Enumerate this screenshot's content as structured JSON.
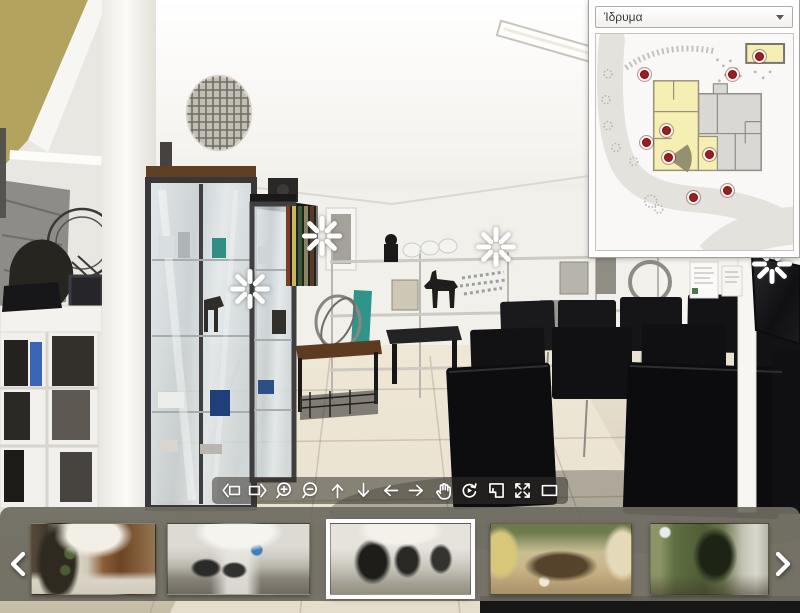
{
  "viewer": {
    "name": "panorama-virtual-tour",
    "sparkles": [
      {
        "x": 322,
        "y": 236
      },
      {
        "x": 250,
        "y": 289
      },
      {
        "x": 496,
        "y": 247
      },
      {
        "x": 772,
        "y": 264
      }
    ]
  },
  "map_panel": {
    "dropdown": {
      "value": "Ίδρυμα",
      "caret_icon": "chevron-down-icon"
    },
    "hotspots": [
      {
        "x": 48,
        "y": 40
      },
      {
        "x": 136,
        "y": 40
      },
      {
        "x": 163,
        "y": 22
      },
      {
        "x": 70,
        "y": 96
      },
      {
        "x": 50,
        "y": 108
      },
      {
        "x": 72,
        "y": 123
      },
      {
        "x": 113,
        "y": 120
      },
      {
        "x": 97,
        "y": 163
      },
      {
        "x": 131,
        "y": 156
      }
    ],
    "fov": {
      "x": 72,
      "y": 125
    },
    "colors": {
      "marker": "#9e1d20",
      "room_highlight": "#f5efb3",
      "room": "#dad8d4",
      "road": "#e4e2dd",
      "fov_cone": "#8c8869"
    }
  },
  "toolbar": {
    "buttons": [
      {
        "name": "step-left-button",
        "icon": "step-left-icon"
      },
      {
        "name": "step-right-button",
        "icon": "step-right-icon"
      },
      {
        "name": "zoom-in-button",
        "icon": "zoom-in-icon"
      },
      {
        "name": "zoom-out-button",
        "icon": "zoom-out-icon"
      },
      {
        "name": "pan-up-button",
        "icon": "arrow-up-icon"
      },
      {
        "name": "pan-down-button",
        "icon": "arrow-down-icon"
      },
      {
        "name": "pan-left-button",
        "icon": "arrow-left-icon"
      },
      {
        "name": "pan-right-button",
        "icon": "arrow-right-icon"
      },
      {
        "name": "drag-mode-button",
        "icon": "hand-icon"
      },
      {
        "name": "autorotate-button",
        "icon": "autorotate-icon"
      },
      {
        "name": "floorplan-toggle-button",
        "icon": "floorplan-icon"
      },
      {
        "name": "fullscreen-button",
        "icon": "fullscreen-icon"
      },
      {
        "name": "windowed-view-button",
        "icon": "window-icon"
      }
    ]
  },
  "filmstrip": {
    "prev_icon": "chevron-left-icon",
    "next_icon": "chevron-right-icon",
    "thumbnails": [
      {
        "scene": "entrance-rock-wood",
        "selected": false
      },
      {
        "scene": "office-room",
        "selected": false
      },
      {
        "scene": "gallery-exhibits",
        "selected": true
      },
      {
        "scene": "courtyard-garden",
        "selected": false
      },
      {
        "scene": "garden-trees",
        "selected": false
      }
    ]
  }
}
